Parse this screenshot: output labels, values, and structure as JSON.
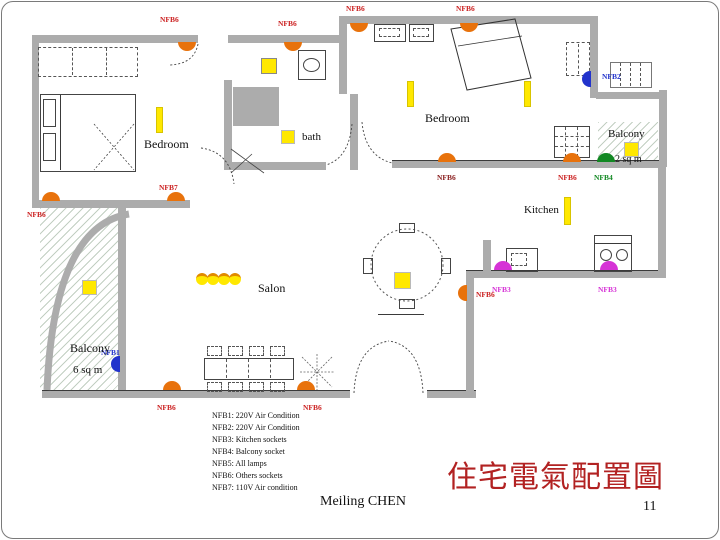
{
  "slide": {
    "title": "住宅電氣配置圖",
    "author": "Meiling CHEN",
    "page_number": "11"
  },
  "plan": {
    "rooms": {
      "bedroom1": "Bedroom",
      "bedroom2": "Bedroom",
      "bath": "bath",
      "kitchen": "Kitchen",
      "salon": "Salon",
      "balcony_tr": "Balcony",
      "balcony_tr_area": "2 sq m",
      "balcony_bl": "Balcony",
      "balcony_bl_area": "6 sq m"
    },
    "markers": [
      {
        "label": "NFB6",
        "color": "#CC2222",
        "dome": "#E8720C"
      },
      {
        "label": "NFB6",
        "color": "#CC2222",
        "dome": "#E8720C"
      },
      {
        "label": "NFB6",
        "color": "#CC2222",
        "dome": "#E8720C"
      },
      {
        "label": "NFB6",
        "color": "#CC2222",
        "dome": "#E8720C"
      },
      {
        "label": "NFB2",
        "color": "#2233CC",
        "dome": "#2233CC"
      },
      {
        "label": "NFB6",
        "color": "#8B2020",
        "dome": "#E8720C"
      },
      {
        "label": "NFB6",
        "color": "#CC2222",
        "dome": "#E8720C"
      },
      {
        "label": "NFB4",
        "color": "#118822",
        "dome": "#118822"
      },
      {
        "label": "NFB3",
        "color": "#D633D6",
        "dome": "#D633D6"
      },
      {
        "label": "NFB3",
        "color": "#D633D6",
        "dome": "#D633D6"
      },
      {
        "label": "NFB6",
        "color": "#CC2222",
        "dome": "#E8720C"
      },
      {
        "label": "NFB6",
        "color": "#CC2222",
        "dome": "#E8720C"
      },
      {
        "label": "NFB6",
        "color": "#CC2222",
        "dome": "#E8720C"
      },
      {
        "label": "NFB6",
        "color": "#CC2222",
        "dome": "#E8720C"
      },
      {
        "label": "NFB7",
        "color": "#CC2222",
        "dome": "#E8720C"
      },
      {
        "label": "NFB1",
        "color": "#2233CC",
        "dome": "#2233CC"
      }
    ]
  },
  "legend": {
    "items": [
      "NFB1: 220V Air Condition",
      "NFB2: 220V Air Condition",
      "NFB3: Kitchen sockets",
      "NFB4: Balcony socket",
      "NFB5: All lamps",
      "NFB6: Others sockets",
      "NFB7: 110V Air condition"
    ]
  },
  "colors": {
    "wall": "#ACACAC",
    "lamp_yellow": "#FFE800",
    "marker_orange": "#E8720C",
    "marker_blue": "#2233CC",
    "marker_green": "#118822",
    "marker_magenta": "#D633D6",
    "label_red": "#CC2222",
    "title_red": "#B22222",
    "hatch_green": "#C2CFC2"
  }
}
